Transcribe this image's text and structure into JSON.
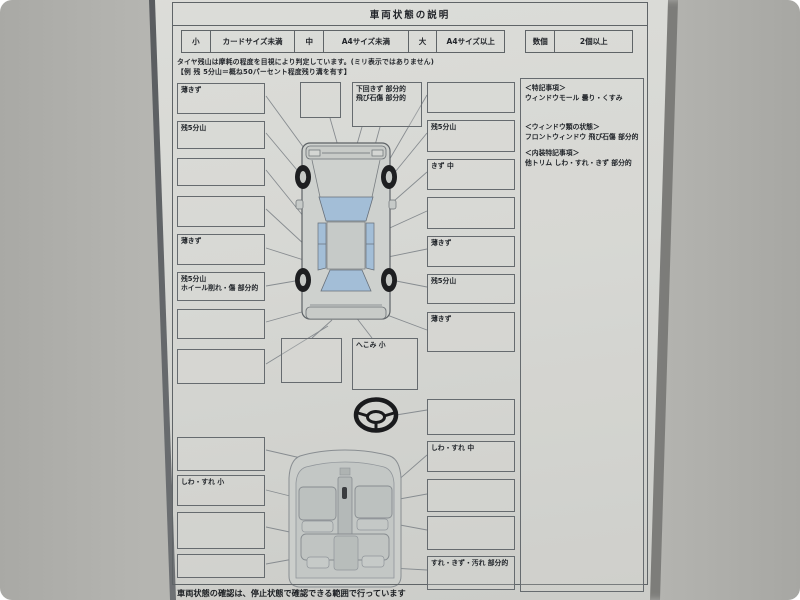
{
  "form": {
    "title": "車両状態の説明",
    "size_legend": [
      {
        "size": "小",
        "desc": "カードサイズ未満"
      },
      {
        "size": "中",
        "desc": "A4サイズ未満"
      },
      {
        "size": "大",
        "desc": "A4サイズ以上"
      }
    ],
    "count_legend": {
      "label": "数個",
      "desc": "2個以上"
    },
    "tire_note_line1": "タイヤ残山は摩耗の程度を目視により判定しています。(ミリ表示ではありません)",
    "tire_note_line2": "【例 残 5分山＝概ね50パーセント程度残り溝を有す】",
    "footer_note": "車両状態の確認は、停止状態で確認できる範囲で行っています"
  },
  "boxes": {
    "left": [
      "薄きず",
      "残5分山",
      "",
      "",
      "薄きず",
      "残5分山\nホイール削れ・傷 部分的",
      "",
      "",
      "",
      "しわ・すれ 小",
      "",
      ""
    ],
    "right": [
      "",
      "残5分山",
      "きず 中",
      "",
      "薄きず",
      "残5分山",
      "薄きず",
      "",
      "しわ・すれ 中",
      "",
      "",
      "すれ・きず・汚れ 部分的"
    ],
    "center_top_empty": "",
    "center_top": "下回きず 部分的\n飛び石傷 部分的",
    "center_mid_empty": "",
    "center_dent": "へこみ 小"
  },
  "notes_panel": {
    "sections": [
      {
        "title": "＜特記事項＞",
        "body": "ウィンドウモール 曇り・くすみ"
      },
      {
        "title": "＜ウィンドウ類の状態＞",
        "body": "フロントウィンドウ 飛び石傷 部分的"
      },
      {
        "title": "＜内装特記事項＞",
        "body": "他トリム しわ・すれ・きず 部分的"
      }
    ]
  },
  "colors": {
    "paper": "#d6d7d3",
    "background": "#b5b5b1",
    "box_line": "#666b6f",
    "glass_blue": "#a3bed7",
    "tire_black": "#1e1f21"
  }
}
